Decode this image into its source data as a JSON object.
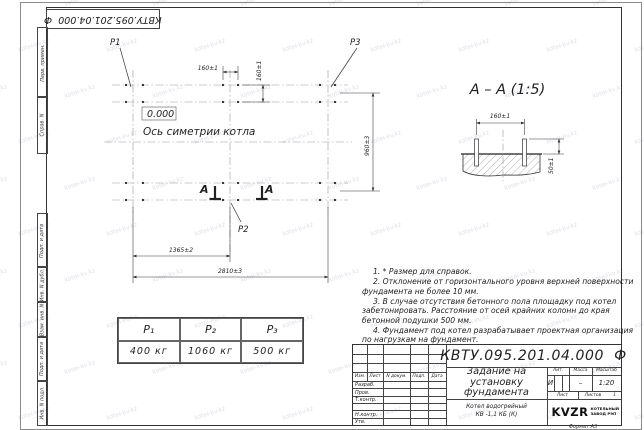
{
  "watermark": {
    "text": "kotel-kv.kz"
  },
  "doc_number": "КВТУ.095.201.04.000  Ф",
  "margin_graphs": {
    "items": [
      "Перв. примен.",
      "Справ. N",
      "Подп. и дата",
      "Инв. N дубл.",
      "Взам. инв. N",
      "Подп. и дата",
      "Инв. N подл."
    ]
  },
  "plan": {
    "p1": "Р1",
    "p2": "Р2",
    "p3": "Р3",
    "elevation": "0.000",
    "axis_caption": "Ось симетрии котла",
    "section_letter_left": "А",
    "section_letter_right": "А",
    "dims": {
      "top_h": "160±1",
      "top_v": "160±1",
      "right_v": "960±3",
      "bottom_inner": "1365±2",
      "bottom_outer": "2810±3"
    }
  },
  "section": {
    "title": "А – А (1:5)",
    "dim_h": "160±1",
    "dim_v": "50±1"
  },
  "notes": {
    "items": [
      "1. * Размер для справок.",
      "2. Отклонение от горизонтального уровня верхней поверхности фундамента не более 10 мм.",
      "3. В случае отсутствия бетонного пола площадку под котел забетонировать. Расстояние от осей крайних колонн до края бетонной подушки 500 мм.",
      "4. Фундамент под котел разрабатывает проектная организация по нагрузкам на фундамент."
    ]
  },
  "loads_table": {
    "headers": [
      "Р₁",
      "Р₂",
      "Р₃"
    ],
    "values": [
      "400 кг",
      "1060 кг",
      "500 кг"
    ]
  },
  "title_block": {
    "title_lines": [
      "Задание на",
      "установку",
      "фундамента"
    ],
    "product_lines": [
      "Котел водогрейный",
      "КВ -1,1 КБ  (К)"
    ],
    "sig_headers": [
      "Изм.",
      "Лист",
      "N докум.",
      "Подп.",
      "Дата"
    ],
    "sig_rows": [
      "Разраб.",
      "Пров.",
      "Т.контр.",
      "Н.контр.",
      "Утв."
    ],
    "lit_label": "Лит.",
    "mass_label": "Масса",
    "scale_label": "Масштаб",
    "lit_value": "И",
    "mass_value": "–",
    "scale_value": "1:20",
    "sheet_label": "Лист",
    "sheets_label": "Листов",
    "sheets_value": "1",
    "logo_text": "KVZR",
    "logo_sub1": "КОТЕЛЬНЫЙ",
    "logo_sub2": "ЗАВОД РЭП",
    "format_label": "Формат А3"
  }
}
